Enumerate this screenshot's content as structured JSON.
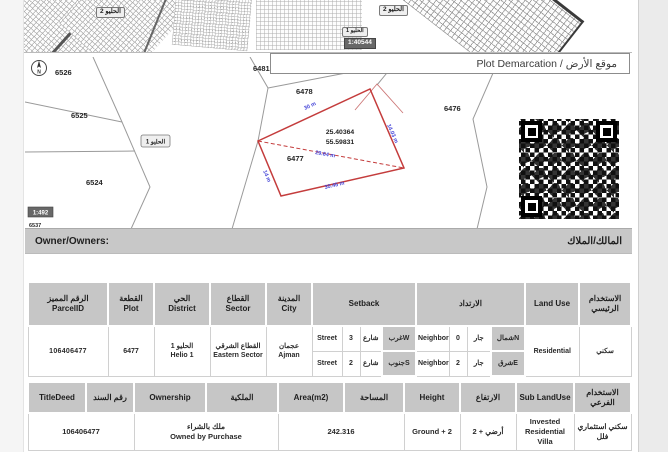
{
  "colors": {
    "plot_outline": "#c43c3c",
    "dimension_text": "#4646d8",
    "header_bg": "#c6c6c6"
  },
  "overview": {
    "chip_left": "الحليو 2",
    "chip_right": "الحليو 2",
    "chip_small": "الحليو 1",
    "scale": "1:40544"
  },
  "title_bar": "Plot Demarcation / موقع الأرض",
  "map": {
    "compass": "N",
    "scale": "1:492",
    "district_chip": "الحليو 1",
    "parcels": {
      "p6526": "6526",
      "p6525": "6525",
      "p6524": "6524",
      "p6537": "6537",
      "p6481": "6481",
      "p6478": "6478",
      "p6479": "6479",
      "p6476": "6476"
    },
    "plot": {
      "number": "6477",
      "latitude": "25.40364",
      "longitude": "55.59831",
      "dim_top": "30 m",
      "dim_right": "14.03 m",
      "dim_bottom": "30.45 m",
      "dim_left": "14 m",
      "dim_diagonal": "29.64 m"
    }
  },
  "owner_bar": {
    "en": "Owner/Owners:",
    "ar": "المالك/الملاك"
  },
  "table1": {
    "headers": {
      "parcel_ar": "الرقم المميز",
      "parcel_en": "ParcelID",
      "plot_ar": "القطعة",
      "plot_en": "Plot",
      "district_ar": "الحي",
      "district_en": "District",
      "sector_ar": "القطاع",
      "sector_en": "Sector",
      "city_ar": "المدينة",
      "city_en": "City",
      "setback_en": "Setback",
      "setback_ar": "الارتداد",
      "landuse_en": "Land Use",
      "landuse_ar": "الاستخدام الرئيسي"
    },
    "row": {
      "parcel_id": "106406477",
      "plot": "6477",
      "district_ar": "الحليو 1",
      "district_en": "Helio 1",
      "sector_ar": "القطاع الشرقي",
      "sector_en": "Eastern Sector",
      "city_ar": "عجمان",
      "city_en": "Ajman",
      "setbacks": [
        {
          "type_en": "Street",
          "value": "3",
          "type_ar": "شارع",
          "dir": "غربW",
          "n_en": "Neighbor",
          "n_val": "0",
          "n_ar": "جار",
          "n_dir": "شمالN"
        },
        {
          "type_en": "Street",
          "value": "2",
          "type_ar": "شارع",
          "dir": "جنوبS",
          "n_en": "Neighbor",
          "n_val": "2",
          "n_ar": "جار",
          "n_dir": "شرقE"
        }
      ],
      "landuse_en": "Residential",
      "landuse_ar": "سكني"
    }
  },
  "table2": {
    "headers": {
      "titledeed_en": "TitleDeed",
      "titledeed_ar": "رقم السند",
      "ownership_en": "Ownership",
      "ownership_ar": "الملكية",
      "area_en": "Area(m2)",
      "area_ar": "المساحة",
      "height_en": "Height",
      "height_ar": "الارتفاع",
      "sub_en": "Sub LandUse",
      "sub_ar": "الاستخدام الفرعي"
    },
    "row": {
      "titledeed": "106406477",
      "ownership_ar": "ملك بالشراء",
      "ownership_en": "Owned by Purchase",
      "area": "242.316",
      "height_en": "Ground + 2",
      "height_ar": "أرضي + 2",
      "sub_en": "Invested Residential Villa",
      "sub_ar": "سكني استثماري فلل"
    }
  }
}
